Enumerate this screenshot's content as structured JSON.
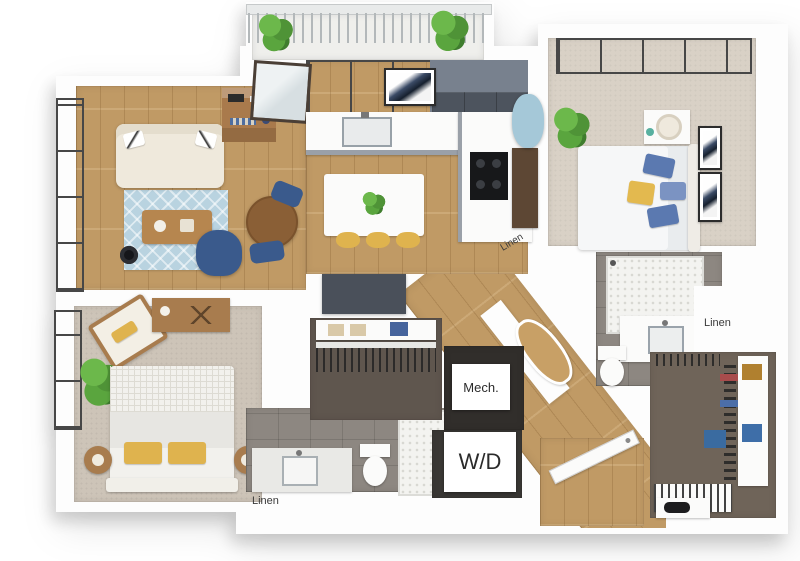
{
  "title": "3D apartment floor plan rendering",
  "labels": {
    "hall_linen": "Linen",
    "master_linen": "Linen",
    "bath_linen": "Linen",
    "mech": "Mech.",
    "wd": "W/D"
  },
  "rooms": [
    {
      "name": "balcony",
      "furniture": [
        "railing",
        "potted-plant",
        "potted-plant"
      ]
    },
    {
      "name": "living-room",
      "furniture": [
        "sofa",
        "area-rug",
        "coffee-table",
        "floor-lamp",
        "swivel-armchair",
        "round-dining-table",
        "dining-chair",
        "dining-chair",
        "bookshelf",
        "floor-to-ceiling-windows"
      ]
    },
    {
      "name": "kitchen",
      "furniture": [
        "l-shaped-counter",
        "sink",
        "cooktop",
        "upper-cabinets",
        "island",
        "bar-stool",
        "bar-stool",
        "bar-stool",
        "island-plant",
        "framed-art",
        "tall-cabinet",
        "balcony-door"
      ]
    },
    {
      "name": "master-bedroom",
      "furniture": [
        "bed",
        "nightstand",
        "table-lamp",
        "framed-art",
        "framed-art",
        "accent-chair",
        "potted-plant",
        "corner-window"
      ]
    },
    {
      "name": "master-bathroom",
      "furniture": [
        "walk-in-shower",
        "vanity-sink",
        "toilet",
        "counter"
      ]
    },
    {
      "name": "master-closet",
      "furniture": [
        "hanging-clothes",
        "shelving",
        "storage-bin",
        "storage-bin",
        "shoe-rack"
      ]
    },
    {
      "name": "bedroom-2",
      "furniture": [
        "bed",
        "side-table",
        "side-table",
        "lounge-chair",
        "media-console",
        "potted-plant",
        "windows"
      ]
    },
    {
      "name": "bathroom-2",
      "furniture": [
        "vanity-sink",
        "toilet",
        "shower"
      ]
    },
    {
      "name": "walk-in-closet",
      "furniture": [
        "hanging-clothes",
        "shelf",
        "folded-towels"
      ]
    },
    {
      "name": "mechanical-room",
      "label": "Mech."
    },
    {
      "name": "laundry-closet",
      "label": "W/D",
      "furniture": [
        "stacked-washer-dryer"
      ]
    },
    {
      "name": "hallway",
      "furniture": [
        "wood-floor",
        "wall-niche"
      ]
    },
    {
      "name": "entry",
      "furniture": [
        "entry-door",
        "console",
        "shoe-shelf"
      ]
    }
  ],
  "colors": {
    "background": "#ffffff",
    "walls": "#fdfdfd",
    "wood_floor": "#c69f68",
    "carpet_master": "#d9d1c6",
    "carpet_bedroom2": "#cdc4b8",
    "bath_tile": "#8d8781",
    "closet_floor": "#6f6459",
    "rug_blue": "#b9d3e0",
    "accent_navy": "#3a5a8c",
    "accent_yellow": "#dfb34e",
    "cabinet_gray": "#4d545e",
    "plant_green": "#57a33c",
    "chair_light_blue": "#a5c8d8"
  }
}
